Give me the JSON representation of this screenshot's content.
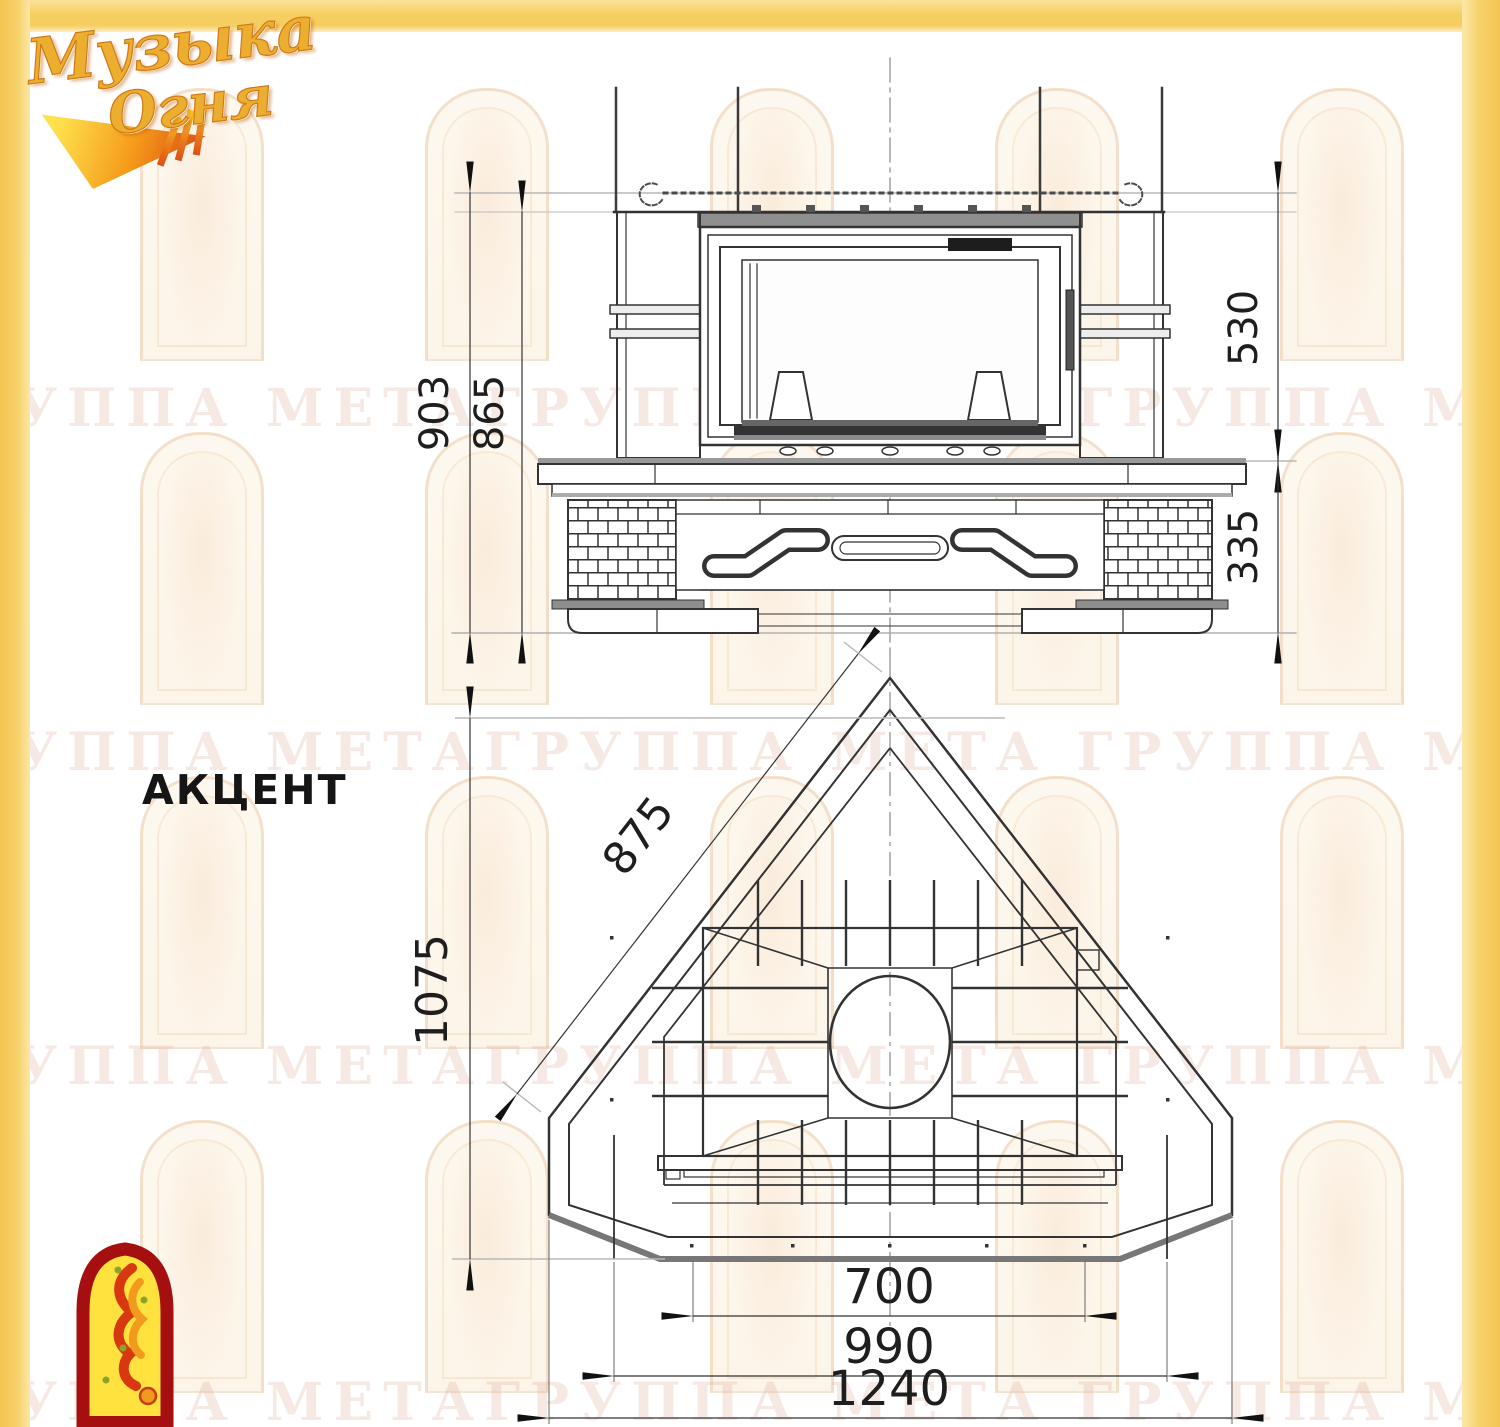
{
  "branding": {
    "logo_word1": "Музыка",
    "logo_word2": "Огня"
  },
  "model_label": "АКЦЕНТ",
  "watermark": {
    "text": "ГРУППА МЕТАГРУППА МЕТА",
    "text_rows_y": [
      378,
      722,
      1036,
      1372
    ],
    "arch_cols_x": [
      140,
      425,
      710,
      995,
      1280
    ],
    "arch_rows_y": [
      88,
      432,
      776,
      1120
    ]
  },
  "front_view": {
    "dims": {
      "total_height": "903",
      "opening_height": "865",
      "firebox_height": "530",
      "base_height": "335"
    }
  },
  "plan_view": {
    "dims": {
      "side_edge": "875",
      "depth": "1075",
      "hearth_front": "700",
      "base_middle": "990",
      "overall_width": "1240"
    }
  },
  "colors": {
    "border_yellow": "#f6cd60",
    "line_dark": "#333333",
    "line_gray": "#b5b5b5",
    "emblem_red": "#a50f0f",
    "emblem_yellow": "#ffe23e"
  }
}
